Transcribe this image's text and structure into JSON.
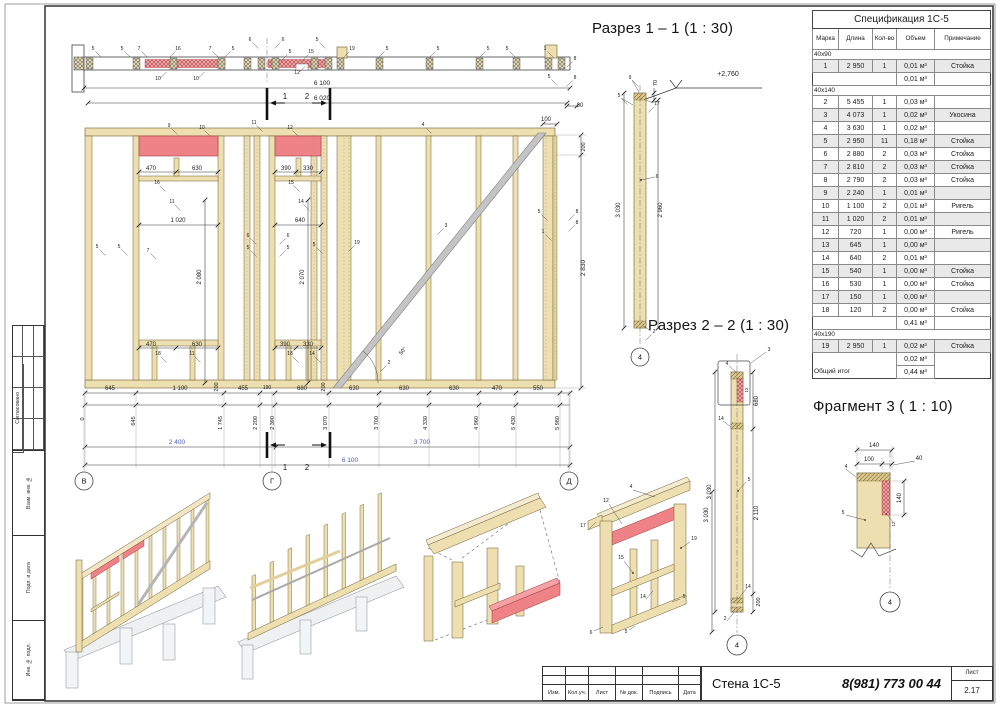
{
  "colors": {
    "dim_blue": "#4a5bb0",
    "wood": "#eedfb0",
    "red": "#ef8287",
    "accent_red": "#c0392b"
  },
  "titles": {
    "section_1_1": "Разрез 1 – 1 (1 : 30)",
    "section_2_2": "Разрез 2 – 2 (1 : 30)",
    "fragment_3": "Фрагмент 3 ( 1 : 10)"
  },
  "sheet": {
    "left_stamp": {
      "agreed": "Согласовано",
      "boxes": [
        "Взам. инв. №",
        "Подп. и дата",
        "Инв. № подл."
      ]
    },
    "title_block": {
      "columns": [
        "Изм.",
        "Кол.уч.",
        "Лист",
        "№ док.",
        "Подпись",
        "Дата"
      ],
      "doc_title": "Стена 1С-5",
      "phone": "8(981) 773 00 44",
      "sheet_label": "Лист",
      "sheet_number": "2.17"
    }
  },
  "spec_table": {
    "title": "Спецификация 1С-5",
    "columns": [
      "Марка",
      "Длина",
      "Кол-во",
      "Объем",
      "Примечание"
    ],
    "sections": [
      {
        "group": "40х90",
        "rows": [
          {
            "mark": "1",
            "len": "2 950",
            "qty": "1",
            "vol": "0,01 м³",
            "note": "Стойка"
          }
        ],
        "subtotal": "0,01 м³"
      },
      {
        "group": "40х140",
        "rows": [
          {
            "mark": "2",
            "len": "5 455",
            "qty": "1",
            "vol": "0,03 м³",
            "note": ""
          },
          {
            "mark": "3",
            "len": "4 073",
            "qty": "1",
            "vol": "0,02 м³",
            "note": "Укосина"
          },
          {
            "mark": "4",
            "len": "3 630",
            "qty": "1",
            "vol": "0,02 м³",
            "note": ""
          },
          {
            "mark": "5",
            "len": "2 950",
            "qty": "11",
            "vol": "0,18 м³",
            "note": "Стойка"
          },
          {
            "mark": "6",
            "len": "2 880",
            "qty": "2",
            "vol": "0,03 м³",
            "note": "Стойка"
          },
          {
            "mark": "7",
            "len": "2 810",
            "qty": "2",
            "vol": "0,03 м³",
            "note": "Стойка"
          },
          {
            "mark": "8",
            "len": "2 790",
            "qty": "2",
            "vol": "0,03 м³",
            "note": "Стойка"
          },
          {
            "mark": "9",
            "len": "2 240",
            "qty": "1",
            "vol": "0,01 м³",
            "note": ""
          },
          {
            "mark": "10",
            "len": "1 100",
            "qty": "2",
            "vol": "0,01 м³",
            "note": "Ригель"
          },
          {
            "mark": "11",
            "len": "1 020",
            "qty": "2",
            "vol": "0,01 м³",
            "note": ""
          },
          {
            "mark": "12",
            "len": "720",
            "qty": "1",
            "vol": "0,00 м³",
            "note": "Ригель"
          },
          {
            "mark": "13",
            "len": "645",
            "qty": "1",
            "vol": "0,00 м³",
            "note": ""
          },
          {
            "mark": "14",
            "len": "640",
            "qty": "2",
            "vol": "0,01 м³",
            "note": ""
          },
          {
            "mark": "15",
            "len": "540",
            "qty": "1",
            "vol": "0,00 м³",
            "note": "Стойка"
          },
          {
            "mark": "16",
            "len": "530",
            "qty": "1",
            "vol": "0,00 м³",
            "note": "Стойка"
          },
          {
            "mark": "17",
            "len": "150",
            "qty": "1",
            "vol": "0,00 м³",
            "note": ""
          },
          {
            "mark": "18",
            "len": "120",
            "qty": "2",
            "vol": "0,00 м³",
            "note": "Стойка"
          }
        ],
        "subtotal": "0,41 м³"
      },
      {
        "group": "40х190",
        "rows": [
          {
            "mark": "19",
            "len": "2 950",
            "qty": "1",
            "vol": "0,02 м³",
            "note": "Стойка"
          }
        ],
        "subtotal": "0,02 м³"
      }
    ],
    "total_label": "Общий итог",
    "total_value": "0,44 м³"
  },
  "drawing": {
    "bubbles": [
      {
        "t": "В",
        "x": 84,
        "y": 481,
        "rad": 9
      },
      {
        "t": "Г",
        "x": 272,
        "y": 481,
        "rad": 9
      },
      {
        "t": "Д",
        "x": 569,
        "y": 481,
        "rad": 9
      },
      {
        "t": "4",
        "x": 640,
        "y": 357,
        "rad": 9
      },
      {
        "t": "4",
        "x": 737,
        "y": 645,
        "rad": 10
      },
      {
        "t": "4",
        "x": 890,
        "y": 602,
        "rad": 10
      }
    ],
    "labels": [
      {
        "t": "5",
        "x": 93,
        "y": 50,
        "l": 1
      },
      {
        "t": "5",
        "x": 122,
        "y": 50,
        "l": 1
      },
      {
        "t": "7",
        "x": 139,
        "y": 50,
        "l": 1
      },
      {
        "t": "16",
        "x": 178,
        "y": 50,
        "l": 2
      },
      {
        "t": "7",
        "x": 210,
        "y": 50,
        "l": 1
      },
      {
        "t": "5",
        "x": 233,
        "y": 50,
        "l": 2
      },
      {
        "t": "6",
        "x": 250,
        "y": 41,
        "l": 1
      },
      {
        "t": "6",
        "x": 283,
        "y": 41,
        "l": 2
      },
      {
        "t": "5",
        "x": 290,
        "y": 53,
        "l": 2
      },
      {
        "t": "15",
        "x": 311,
        "y": 53,
        "l": 2
      },
      {
        "t": "5",
        "x": 317,
        "y": 41,
        "l": 1
      },
      {
        "t": "19",
        "x": 352,
        "y": 50,
        "l": 2
      },
      {
        "t": "5",
        "x": 387,
        "y": 50,
        "l": 2
      },
      {
        "t": "5",
        "x": 438,
        "y": 50,
        "l": 2
      },
      {
        "t": "5",
        "x": 488,
        "y": 50,
        "l": 2
      },
      {
        "t": "5",
        "x": 507,
        "y": 50,
        "l": 1
      },
      {
        "t": "1",
        "x": 545,
        "y": 50,
        "l": 1
      },
      {
        "t": "8",
        "x": 575,
        "y": 60,
        "l": 2
      },
      {
        "t": "5",
        "x": 549,
        "y": 78,
        "l": 1
      },
      {
        "t": "8",
        "x": 575,
        "y": 79,
        "l": 2
      },
      {
        "t": "10",
        "x": 158,
        "y": 80,
        "l": 3
      },
      {
        "t": "10",
        "x": 196,
        "y": 80,
        "l": 3
      },
      {
        "t": "12",
        "x": 297,
        "y": 74,
        "l": 3
      },
      {
        "t": "6 100",
        "x": 322,
        "y": 85,
        "s": 6.5
      },
      {
        "t": "6 020",
        "x": 322,
        "y": 100,
        "s": 6.5
      },
      {
        "t": "1",
        "x": 285,
        "y": 99,
        "s": 8
      },
      {
        "t": "2",
        "x": 307,
        "y": 99,
        "s": 8
      },
      {
        "t": "80",
        "x": 580,
        "y": 107,
        "s": 6
      },
      {
        "t": "100",
        "x": 546,
        "y": 121,
        "s": 6
      },
      {
        "t": "200",
        "x": 585,
        "y": 147,
        "r": -90,
        "s": 5.5
      },
      {
        "t": "2 830",
        "x": 585,
        "y": 268,
        "r": -90,
        "s": 6.5
      },
      {
        "t": "9",
        "x": 169,
        "y": 127,
        "l": 1
      },
      {
        "t": "10",
        "x": 202,
        "y": 129,
        "l": 1
      },
      {
        "t": "11",
        "x": 254,
        "y": 124,
        "l": 1
      },
      {
        "t": "12",
        "x": 290,
        "y": 129,
        "l": 1
      },
      {
        "t": "4",
        "x": 423,
        "y": 126,
        "l": 1
      },
      {
        "t": "470",
        "x": 151,
        "y": 170,
        "s": 6
      },
      {
        "t": "630",
        "x": 197,
        "y": 170,
        "s": 6
      },
      {
        "t": "16",
        "x": 157,
        "y": 184,
        "l": 1
      },
      {
        "t": "11",
        "x": 172,
        "y": 203,
        "l": 1
      },
      {
        "t": "1 020",
        "x": 178,
        "y": 222,
        "s": 6
      },
      {
        "t": "390",
        "x": 286,
        "y": 170,
        "s": 6
      },
      {
        "t": "330",
        "x": 308,
        "y": 170,
        "s": 6
      },
      {
        "t": "15",
        "x": 291,
        "y": 184,
        "l": 1
      },
      {
        "t": "14",
        "x": 301,
        "y": 203,
        "l": 1
      },
      {
        "t": "640",
        "x": 300,
        "y": 222,
        "s": 6
      },
      {
        "t": "2 080",
        "x": 201,
        "y": 277,
        "r": -90,
        "s": 6
      },
      {
        "t": "2 070",
        "x": 304,
        "y": 277,
        "r": -90,
        "s": 6
      },
      {
        "t": "5",
        "x": 97,
        "y": 248,
        "l": 1
      },
      {
        "t": "5",
        "x": 119,
        "y": 248,
        "l": 1
      },
      {
        "t": "7",
        "x": 148,
        "y": 252,
        "l": 1
      },
      {
        "t": "6",
        "x": 248,
        "y": 237,
        "l": 1
      },
      {
        "t": "5",
        "x": 248,
        "y": 249,
        "l": 1
      },
      {
        "t": "6",
        "x": 288,
        "y": 237,
        "l": 2
      },
      {
        "t": "5",
        "x": 288,
        "y": 249,
        "l": 2
      },
      {
        "t": "5",
        "x": 314,
        "y": 246,
        "l": 1
      },
      {
        "t": "19",
        "x": 357,
        "y": 244,
        "l": 2
      },
      {
        "t": "3",
        "x": 446,
        "y": 227,
        "l": 2
      },
      {
        "t": "5",
        "x": 539,
        "y": 213,
        "l": 1
      },
      {
        "t": "8",
        "x": 577,
        "y": 213,
        "l": 2
      },
      {
        "t": "8",
        "x": 577,
        "y": 224,
        "l": 2
      },
      {
        "t": "1",
        "x": 543,
        "y": 233,
        "l": 1
      },
      {
        "t": "50°",
        "x": 404,
        "y": 352,
        "r": -50,
        "s": 5.5
      },
      {
        "t": "2",
        "x": 389,
        "y": 364,
        "l": 2
      },
      {
        "t": "470",
        "x": 151,
        "y": 346,
        "s": 6
      },
      {
        "t": "630",
        "x": 197,
        "y": 346,
        "s": 6
      },
      {
        "t": "18",
        "x": 158,
        "y": 355,
        "l": 1
      },
      {
        "t": "11",
        "x": 192,
        "y": 355,
        "l": 1
      },
      {
        "t": "390",
        "x": 285,
        "y": 346,
        "s": 6
      },
      {
        "t": "330",
        "x": 308,
        "y": 346,
        "s": 6
      },
      {
        "t": "18",
        "x": 290,
        "y": 355,
        "l": 1
      },
      {
        "t": "14",
        "x": 312,
        "y": 355,
        "l": 1
      },
      {
        "t": "645",
        "x": 110,
        "y": 390,
        "s": 6
      },
      {
        "t": "1 100",
        "x": 180,
        "y": 390,
        "s": 6
      },
      {
        "t": "200",
        "x": 218,
        "y": 387,
        "r": -90,
        "s": 5.5
      },
      {
        "t": "455",
        "x": 243,
        "y": 390,
        "s": 6
      },
      {
        "t": "190",
        "x": 267,
        "y": 389,
        "s": 5
      },
      {
        "t": "680",
        "x": 302,
        "y": 390,
        "s": 6
      },
      {
        "t": "200",
        "x": 325,
        "y": 387,
        "r": -90,
        "s": 5.5
      },
      {
        "t": "630",
        "x": 354,
        "y": 390,
        "s": 6
      },
      {
        "t": "630",
        "x": 404,
        "y": 390,
        "s": 6
      },
      {
        "t": "630",
        "x": 454,
        "y": 390,
        "s": 6
      },
      {
        "t": "470",
        "x": 497,
        "y": 390,
        "s": 6
      },
      {
        "t": "550",
        "x": 538,
        "y": 390,
        "s": 6
      },
      {
        "t": "0",
        "x": 84,
        "y": 419,
        "r": -90,
        "s": 5.5
      },
      {
        "t": "645",
        "x": 135,
        "y": 421,
        "r": -90,
        "s": 5.5
      },
      {
        "t": "1 745",
        "x": 222,
        "y": 423,
        "r": -90,
        "s": 5.5
      },
      {
        "t": "2 200",
        "x": 257,
        "y": 423,
        "r": -90,
        "s": 5.5
      },
      {
        "t": "2 390",
        "x": 274,
        "y": 423,
        "r": -90,
        "s": 5.5
      },
      {
        "t": "3 070",
        "x": 327,
        "y": 423,
        "r": -90,
        "s": 5.5
      },
      {
        "t": "3 700",
        "x": 378,
        "y": 423,
        "r": -90,
        "s": 5.5
      },
      {
        "t": "4 330",
        "x": 427,
        "y": 423,
        "r": -90,
        "s": 5.5
      },
      {
        "t": "4 960",
        "x": 478,
        "y": 423,
        "r": -90,
        "s": 5.5
      },
      {
        "t": "5 430",
        "x": 515,
        "y": 423,
        "r": -90,
        "s": 5.5
      },
      {
        "t": "5 980",
        "x": 559,
        "y": 423,
        "r": -90,
        "s": 5.5
      },
      {
        "t": "2 400",
        "x": 177,
        "y": 444,
        "s": 6.5,
        "c": "b"
      },
      {
        "t": "3 700",
        "x": 422,
        "y": 444,
        "s": 6.5,
        "c": "b"
      },
      {
        "t": "6 100",
        "x": 350,
        "y": 462,
        "s": 6.5,
        "c": "b"
      },
      {
        "t": "1",
        "x": 285,
        "y": 470,
        "s": 8
      },
      {
        "t": "2",
        "x": 307,
        "y": 470,
        "s": 8
      },
      {
        "t": "9",
        "x": 630,
        "y": 79,
        "l": 1
      },
      {
        "t": "5",
        "x": 619,
        "y": 97,
        "l": 1
      },
      {
        "t": "17",
        "x": 657,
        "y": 105,
        "l": 2
      },
      {
        "t": "70",
        "x": 657,
        "y": 83,
        "r": -90,
        "s": 5.5
      },
      {
        "t": "+2,760",
        "x": 728,
        "y": 76,
        "s": 7
      },
      {
        "t": "3 030",
        "x": 620,
        "y": 210,
        "r": -90,
        "s": 6
      },
      {
        "t": "2 960",
        "x": 662,
        "y": 210,
        "r": -90,
        "s": 6
      },
      {
        "t": "6",
        "x": 657,
        "y": 178
      },
      {
        "t": "2",
        "x": 654,
        "y": 333,
        "l": 2
      },
      {
        "t": "3",
        "x": 769,
        "y": 351
      },
      {
        "t": "4",
        "x": 727,
        "y": 365
      },
      {
        "t": "12",
        "x": 748,
        "y": 390,
        "r": -90,
        "s": 4.5
      },
      {
        "t": "680",
        "x": 758,
        "y": 401,
        "r": -90,
        "s": 6
      },
      {
        "t": "14",
        "x": 721,
        "y": 420
      },
      {
        "t": "5",
        "x": 749,
        "y": 481
      },
      {
        "t": "3 030",
        "x": 711,
        "y": 492,
        "r": -90,
        "s": 6
      },
      {
        "t": "2 110",
        "x": 758,
        "y": 513,
        "r": -90,
        "s": 6
      },
      {
        "t": "14",
        "x": 748,
        "y": 588
      },
      {
        "t": "200",
        "x": 760,
        "y": 602,
        "r": -90,
        "s": 5.5
      },
      {
        "t": "2",
        "x": 725,
        "y": 620
      },
      {
        "t": "140",
        "x": 874,
        "y": 447,
        "s": 6
      },
      {
        "t": "100",
        "x": 869,
        "y": 461,
        "s": 6
      },
      {
        "t": "40",
        "x": 919,
        "y": 460,
        "s": 6
      },
      {
        "t": "4",
        "x": 846,
        "y": 468
      },
      {
        "t": "140",
        "x": 901,
        "y": 498,
        "r": -90,
        "s": 6
      },
      {
        "t": "5",
        "x": 843,
        "y": 514
      },
      {
        "t": "12",
        "x": 895,
        "y": 524,
        "r": -90,
        "s": 4.5
      },
      {
        "t": "4",
        "x": 631,
        "y": 488
      },
      {
        "t": "12",
        "x": 606,
        "y": 502
      },
      {
        "t": "17",
        "x": 583,
        "y": 527
      },
      {
        "t": "15",
        "x": 621,
        "y": 559
      },
      {
        "t": "19",
        "x": 694,
        "y": 540
      },
      {
        "t": "14",
        "x": 643,
        "y": 598
      },
      {
        "t": "5",
        "x": 684,
        "y": 598
      },
      {
        "t": "6",
        "x": 591,
        "y": 634
      },
      {
        "t": "5",
        "x": 626,
        "y": 633
      },
      {
        "t": "3 030",
        "x": 708,
        "y": 515,
        "r": -90,
        "s": 6
      }
    ]
  }
}
